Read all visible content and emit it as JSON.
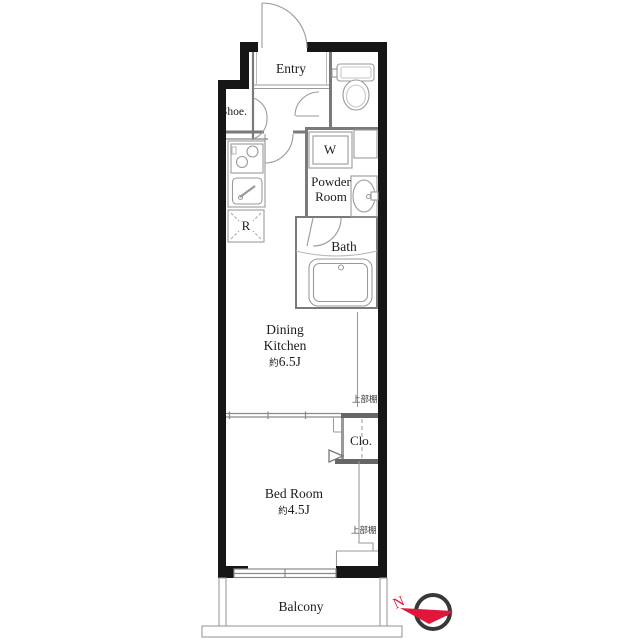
{
  "floorplan": {
    "labels": {
      "entry": "Entry",
      "shoe": "Shoe.",
      "washer": "W",
      "powder_room_line1": "Powder",
      "powder_room_line2": "Room",
      "bath": "Bath",
      "refrigerator": "R",
      "dining_kitchen_line1": "Dining",
      "dining_kitchen_line2": "Kitchen",
      "dining_kitchen_area_prefix": "約",
      "dining_kitchen_area": "6.5J",
      "upper_shelf_1": "上部棚",
      "closet": "Clo.",
      "bedroom": "Bed Room",
      "bedroom_area_prefix": "約",
      "bedroom_area": "4.5J",
      "upper_shelf_2": "上部棚",
      "balcony": "Balcony"
    },
    "compass": {
      "north": "N"
    },
    "colors": {
      "wall": "#161616",
      "partition_line": "#7a7a7a",
      "fixture_line": "#9a9a9a",
      "text": "#1d1d1d",
      "compass_red": "#e0173a",
      "compass_ring": "#383838"
    }
  }
}
